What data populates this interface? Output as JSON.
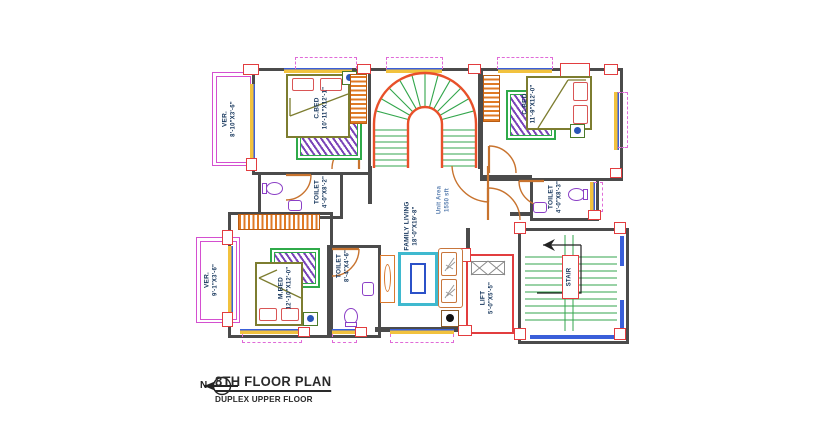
{
  "title_block": {
    "title": "8TH FLOOR PLAN",
    "subtitle": "DUPLEX UPPER FLOOR",
    "north_label": "N"
  },
  "rooms": {
    "bed_top_left": {
      "name": "C.BED",
      "size": "10'-11\"X12'-1\""
    },
    "bed_top_right": {
      "name": "C.BED",
      "size": "11'-9\"X12'-0\""
    },
    "bed_master": {
      "name": "M.BED",
      "size": "12'-10\"X12'-0\""
    },
    "toilet_left": {
      "name": "TOILET",
      "size": "4'-0\"X8'-2\""
    },
    "toilet_right": {
      "name": "TOILET",
      "size": "4'-0\"X8'-3\""
    },
    "toilet_bottom": {
      "name": "TOILET",
      "size": "8'-4\"X4'-6\""
    },
    "family_living": {
      "name": "FAMILY LIVING",
      "size": "18'-0\"X19'-8\""
    },
    "veranda_top": {
      "name": "VER.",
      "size": "8'-10\"X3'-6\""
    },
    "veranda_bottom": {
      "name": "VER.",
      "size": "9'-1\"X3'-6\""
    },
    "lift": {
      "name": "LIFT",
      "size": "5'-0\"X5'-5\""
    },
    "stair": {
      "name": "STAIR"
    },
    "unit_area": {
      "line1": "Unit Area",
      "line2": "1550 sft"
    }
  },
  "colors": {
    "wall": "#4b4b4b",
    "column_red": "#e23d3f",
    "door_orange": "#c8732e",
    "stair_tread_green": "#33a64c",
    "stair_stringer_red": "#e8502a",
    "fixture_purple": "#8b3fc6",
    "rug_green": "#2faa4a",
    "rug_pattern_purple": "#7a44b8",
    "veranda_magenta": "#d44fd0",
    "window_blue": "#3a5fd9",
    "window_sill_yellow": "#f2c23e",
    "tv_unit_cyan": "#3fb9cf",
    "bed_olive": "#7d7d30"
  }
}
